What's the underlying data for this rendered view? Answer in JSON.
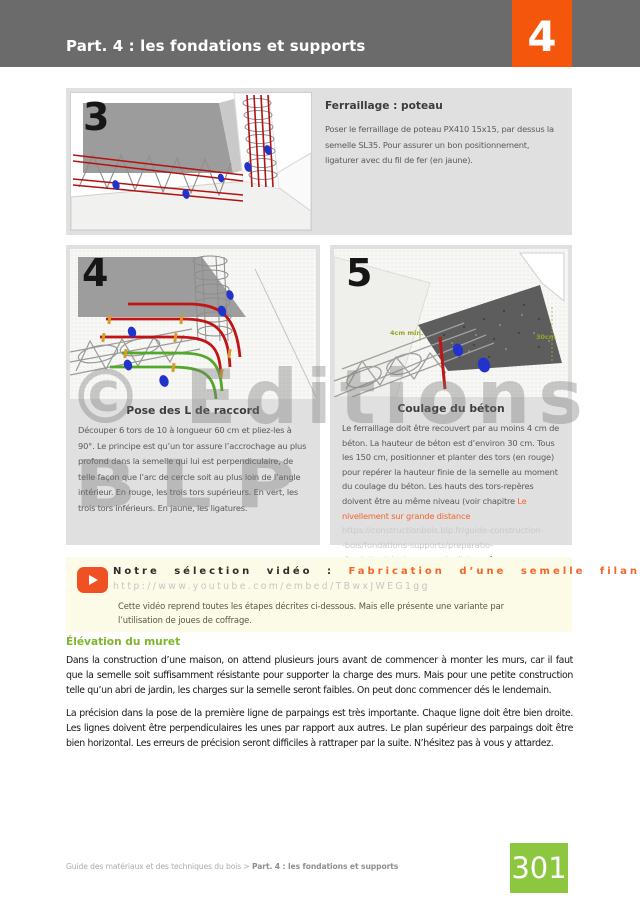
{
  "header": {
    "title": "Part. 4 : les fondations et supports",
    "chapter_number": "4"
  },
  "steps": {
    "step3": {
      "number": "3",
      "title": "Ferraillage : poteau",
      "body": "Poser le ferraillage de poteau PX410 15x15, par dessus la semelle SL35. Pour assurer un bon positionnement, ligaturer avec du fil de fer (en jaune)."
    },
    "step4": {
      "number": "4",
      "title": "Pose des L de raccord",
      "body": "Découper 6 tors de 10 à longueur 60 cm et pliez-les à 90°. Le principe est qu’un tor assure l’accrochage au plus profond dans la semelle qui lui est perpendiculaire, de telle façon que l’arc de cercle soit au plus loin de l’angle intérieur. En rouge, les trois tors supérieurs. En vert, les trois tors inférieurs. En jaune, les ligatures."
    },
    "step5": {
      "number": "5",
      "title": "Coulage du béton",
      "body_before_link": "Le ferraillage doit être recouvert par au moins 4 cm de béton. La hauteur de béton est d’environ 30 cm. Tous les 150 cm, positionner et planter des tors (en rouge) pour repérer la hauteur finie de la semelle au moment du coulage du béton. Les hauts des tors-repères doivent être au même niveau (voir chapitre ",
      "link_text": "Le nivellement sur grande distance",
      "url_line1": "https://constructionbois.blp.fr/guide-construction-",
      "url_line2": "-bois/fondations-supports/preparatio-",
      "url_line3": "-fondation/nivelage-grande-distance",
      "body_after_link": ").",
      "annotation_dim1": "4cm min.",
      "annotation_dim2": "30cm"
    }
  },
  "video_box": {
    "label": "Notre sélection vidéo :",
    "video_title": "Fabrication d’une semelle filante",
    "url": "http://www.youtube.com/embed/TBwxJWEG1gg",
    "description": "Cette vidéo reprend toutes les étapes décrites ci-dessous. Mais elle présente une variante par l’utilisation de joues de coffrage."
  },
  "section": {
    "heading": "Élévation du muret",
    "paragraph1": "Dans la construction d’une maison, on attend plusieurs jours avant de commencer à monter les murs, car il faut que la semelle soit suffisamment résistante pour supporter la charge des murs. Mais pour une petite construction telle qu’un abri de jardin, les charges sur la semelle seront faibles. On peut donc commencer dés le lendemain.",
    "paragraph2": "La précision dans la pose de la première ligne de parpaings est très importante. Chaque ligne doit être bien droite. Les lignes doivent être perpendiculaires les unes par rapport aux autres. Le plan supérieur des parpaings doit être bien horizontal. Les erreurs de précision seront difficiles à rattraper par la suite. N’hésitez pas à vous y attardez."
  },
  "footer": {
    "breadcrumb_plain": "Guide des matériaux et des techniques du bois > ",
    "breadcrumb_bold": "Part. 4 : les fondations et supports",
    "page_number": "301"
  },
  "watermark": {
    "line1": "© Editions",
    "line2": "BLP"
  },
  "colors": {
    "accent_orange": "#f4560b",
    "link_orange": "#f2662a",
    "heading_green": "#80b62a",
    "page_badge_green": "#8dc63f",
    "header_gray": "#6b6b6b",
    "panel_gray": "#e0e0e0",
    "video_bg": "#fbfbe7",
    "rebar_red": "#bb1414",
    "rebar_green": "#53a829",
    "marker_blue": "#2233cc"
  }
}
